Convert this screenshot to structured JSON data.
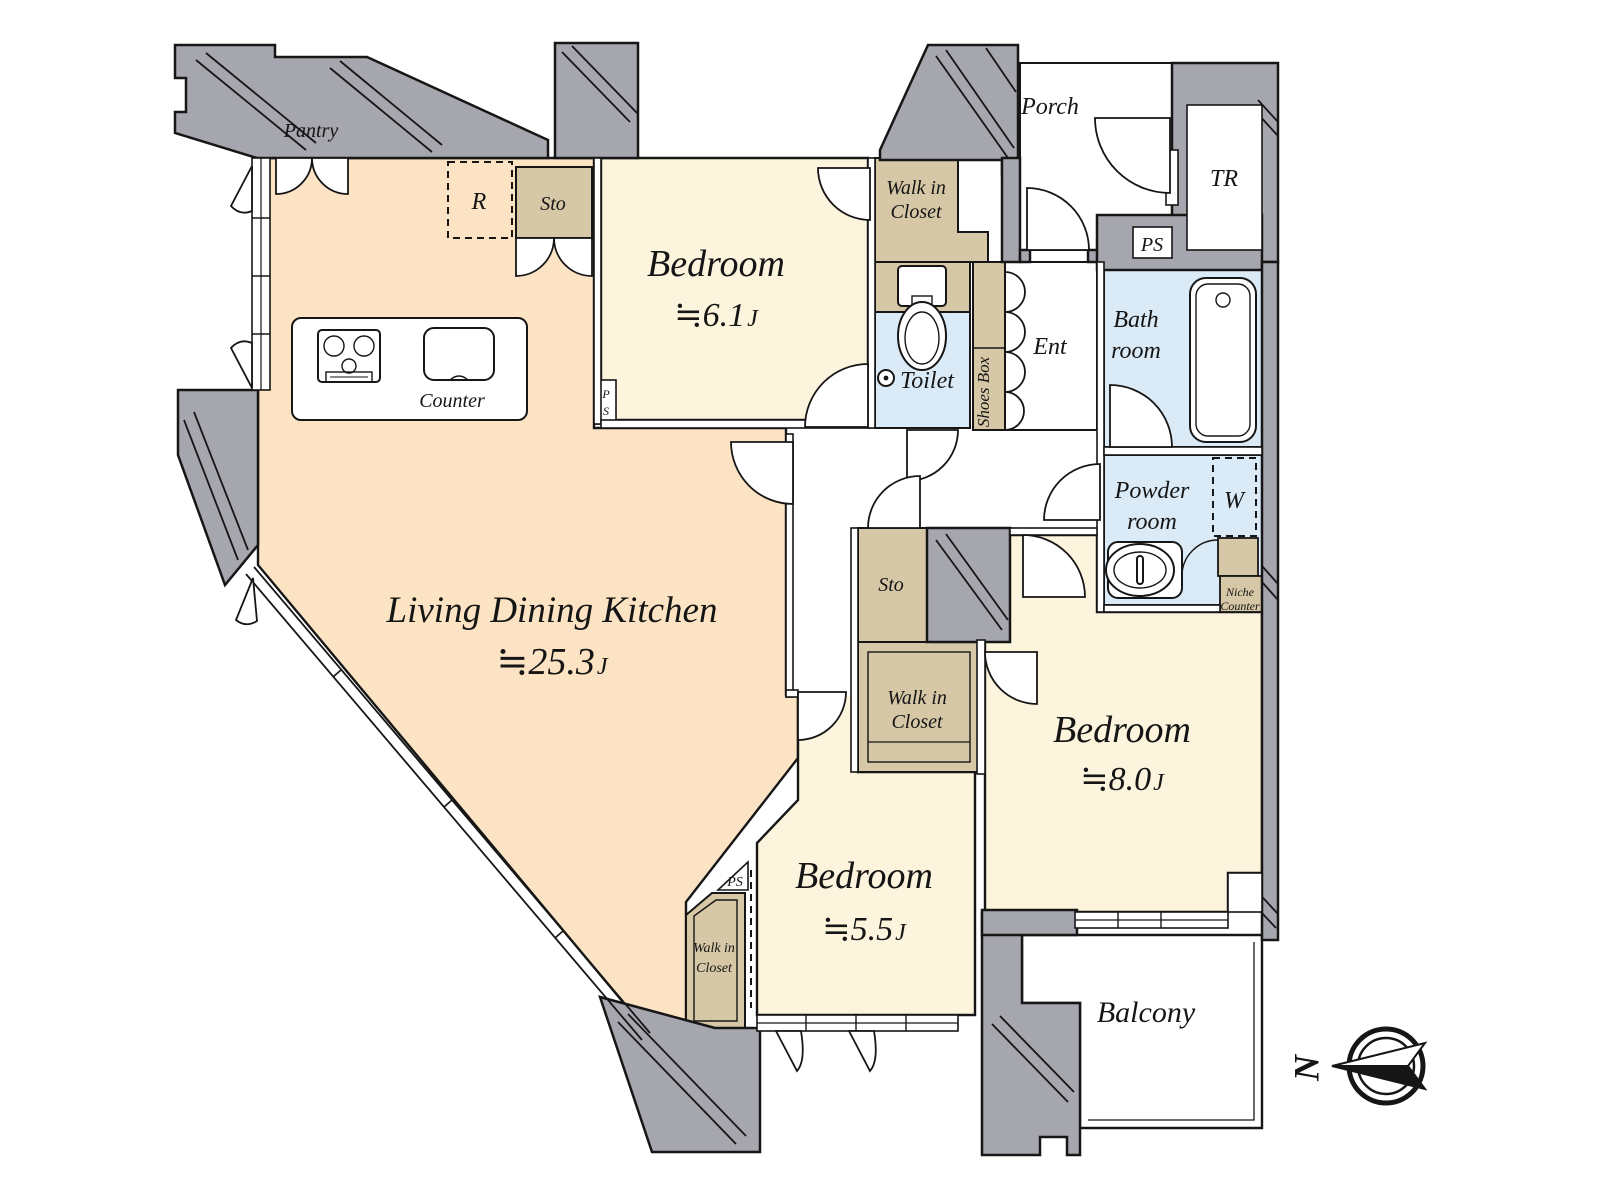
{
  "colors": {
    "wall_gray": "#a6a6ae",
    "outline": "#161616",
    "ldk_floor": "#fbe3c3",
    "bedroom_floor": "#fcf4dc",
    "wet_floor": "#daeaf6",
    "storage_fill": "#d6c7a6",
    "white": "#ffffff"
  },
  "rooms": {
    "ldk": {
      "name": "Living Dining Kitchen",
      "size": "≒25.3",
      "unit": "J"
    },
    "bedroom_top": {
      "name": "Bedroom",
      "size": "≒6.1",
      "unit": "J"
    },
    "bedroom_right": {
      "name": "Bedroom",
      "size": "≒8.0",
      "unit": "J"
    },
    "bedroom_bottom": {
      "name": "Bedroom",
      "size": "≒5.5",
      "unit": "J"
    },
    "bath": {
      "line1": "Bath",
      "line2": "room"
    },
    "powder": {
      "line1": "Powder",
      "line2": "room"
    },
    "toilet": "Toilet",
    "entrance": "Ent",
    "porch": "Porch",
    "trunk_room": "TR",
    "balcony": "Balcony"
  },
  "features": {
    "pantry": "Pantry",
    "refrigerator": "R",
    "storage": "Sto",
    "counter": "Counter",
    "walk_in_closet": {
      "line1": "Walk in",
      "line2": "Closet"
    },
    "shoes_box": "Shoes Box",
    "washer": "W",
    "niche_counter": {
      "line1": "Niche",
      "line2": "Counter"
    },
    "pipe_space": "PS",
    "pipe_space_stacked": {
      "line1": "P",
      "line2": "S"
    }
  },
  "compass": {
    "north": "N"
  }
}
